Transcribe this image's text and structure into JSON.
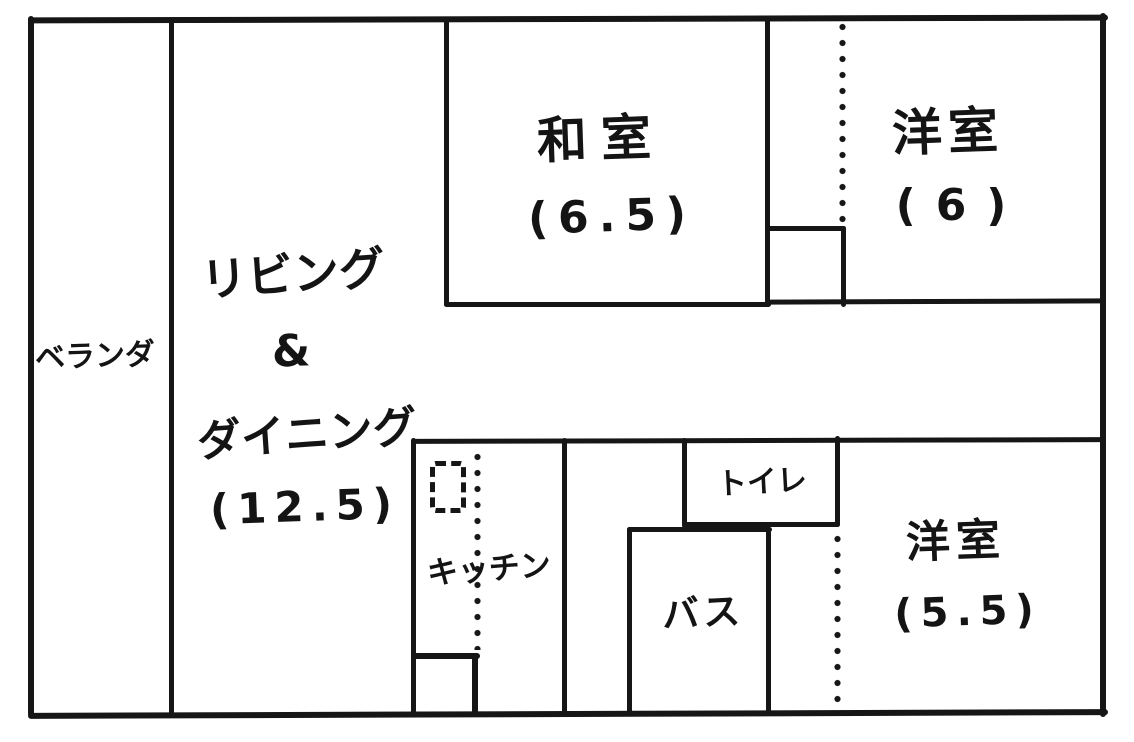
{
  "plan": {
    "kind": "hand-drawn apartment floor plan",
    "rooms": {
      "veranda": {
        "label": "ベランダ"
      },
      "living_dining": {
        "line1": "リビング",
        "line2": "&",
        "line3": "ダイニング",
        "size": "(12.5)"
      },
      "washitsu": {
        "label": "和室",
        "size": "(6.5)"
      },
      "youshitsu_top": {
        "label": "洋室",
        "size": "(6)"
      },
      "kitchen": {
        "label": "キッチン"
      },
      "toilet": {
        "label": "トイレ"
      },
      "bath": {
        "label": "バス"
      },
      "youshitsu_bottom": {
        "label": "洋室",
        "size": "(5.5)"
      }
    },
    "colors": {
      "ink": "#161616",
      "paper": "#ffffff"
    }
  }
}
